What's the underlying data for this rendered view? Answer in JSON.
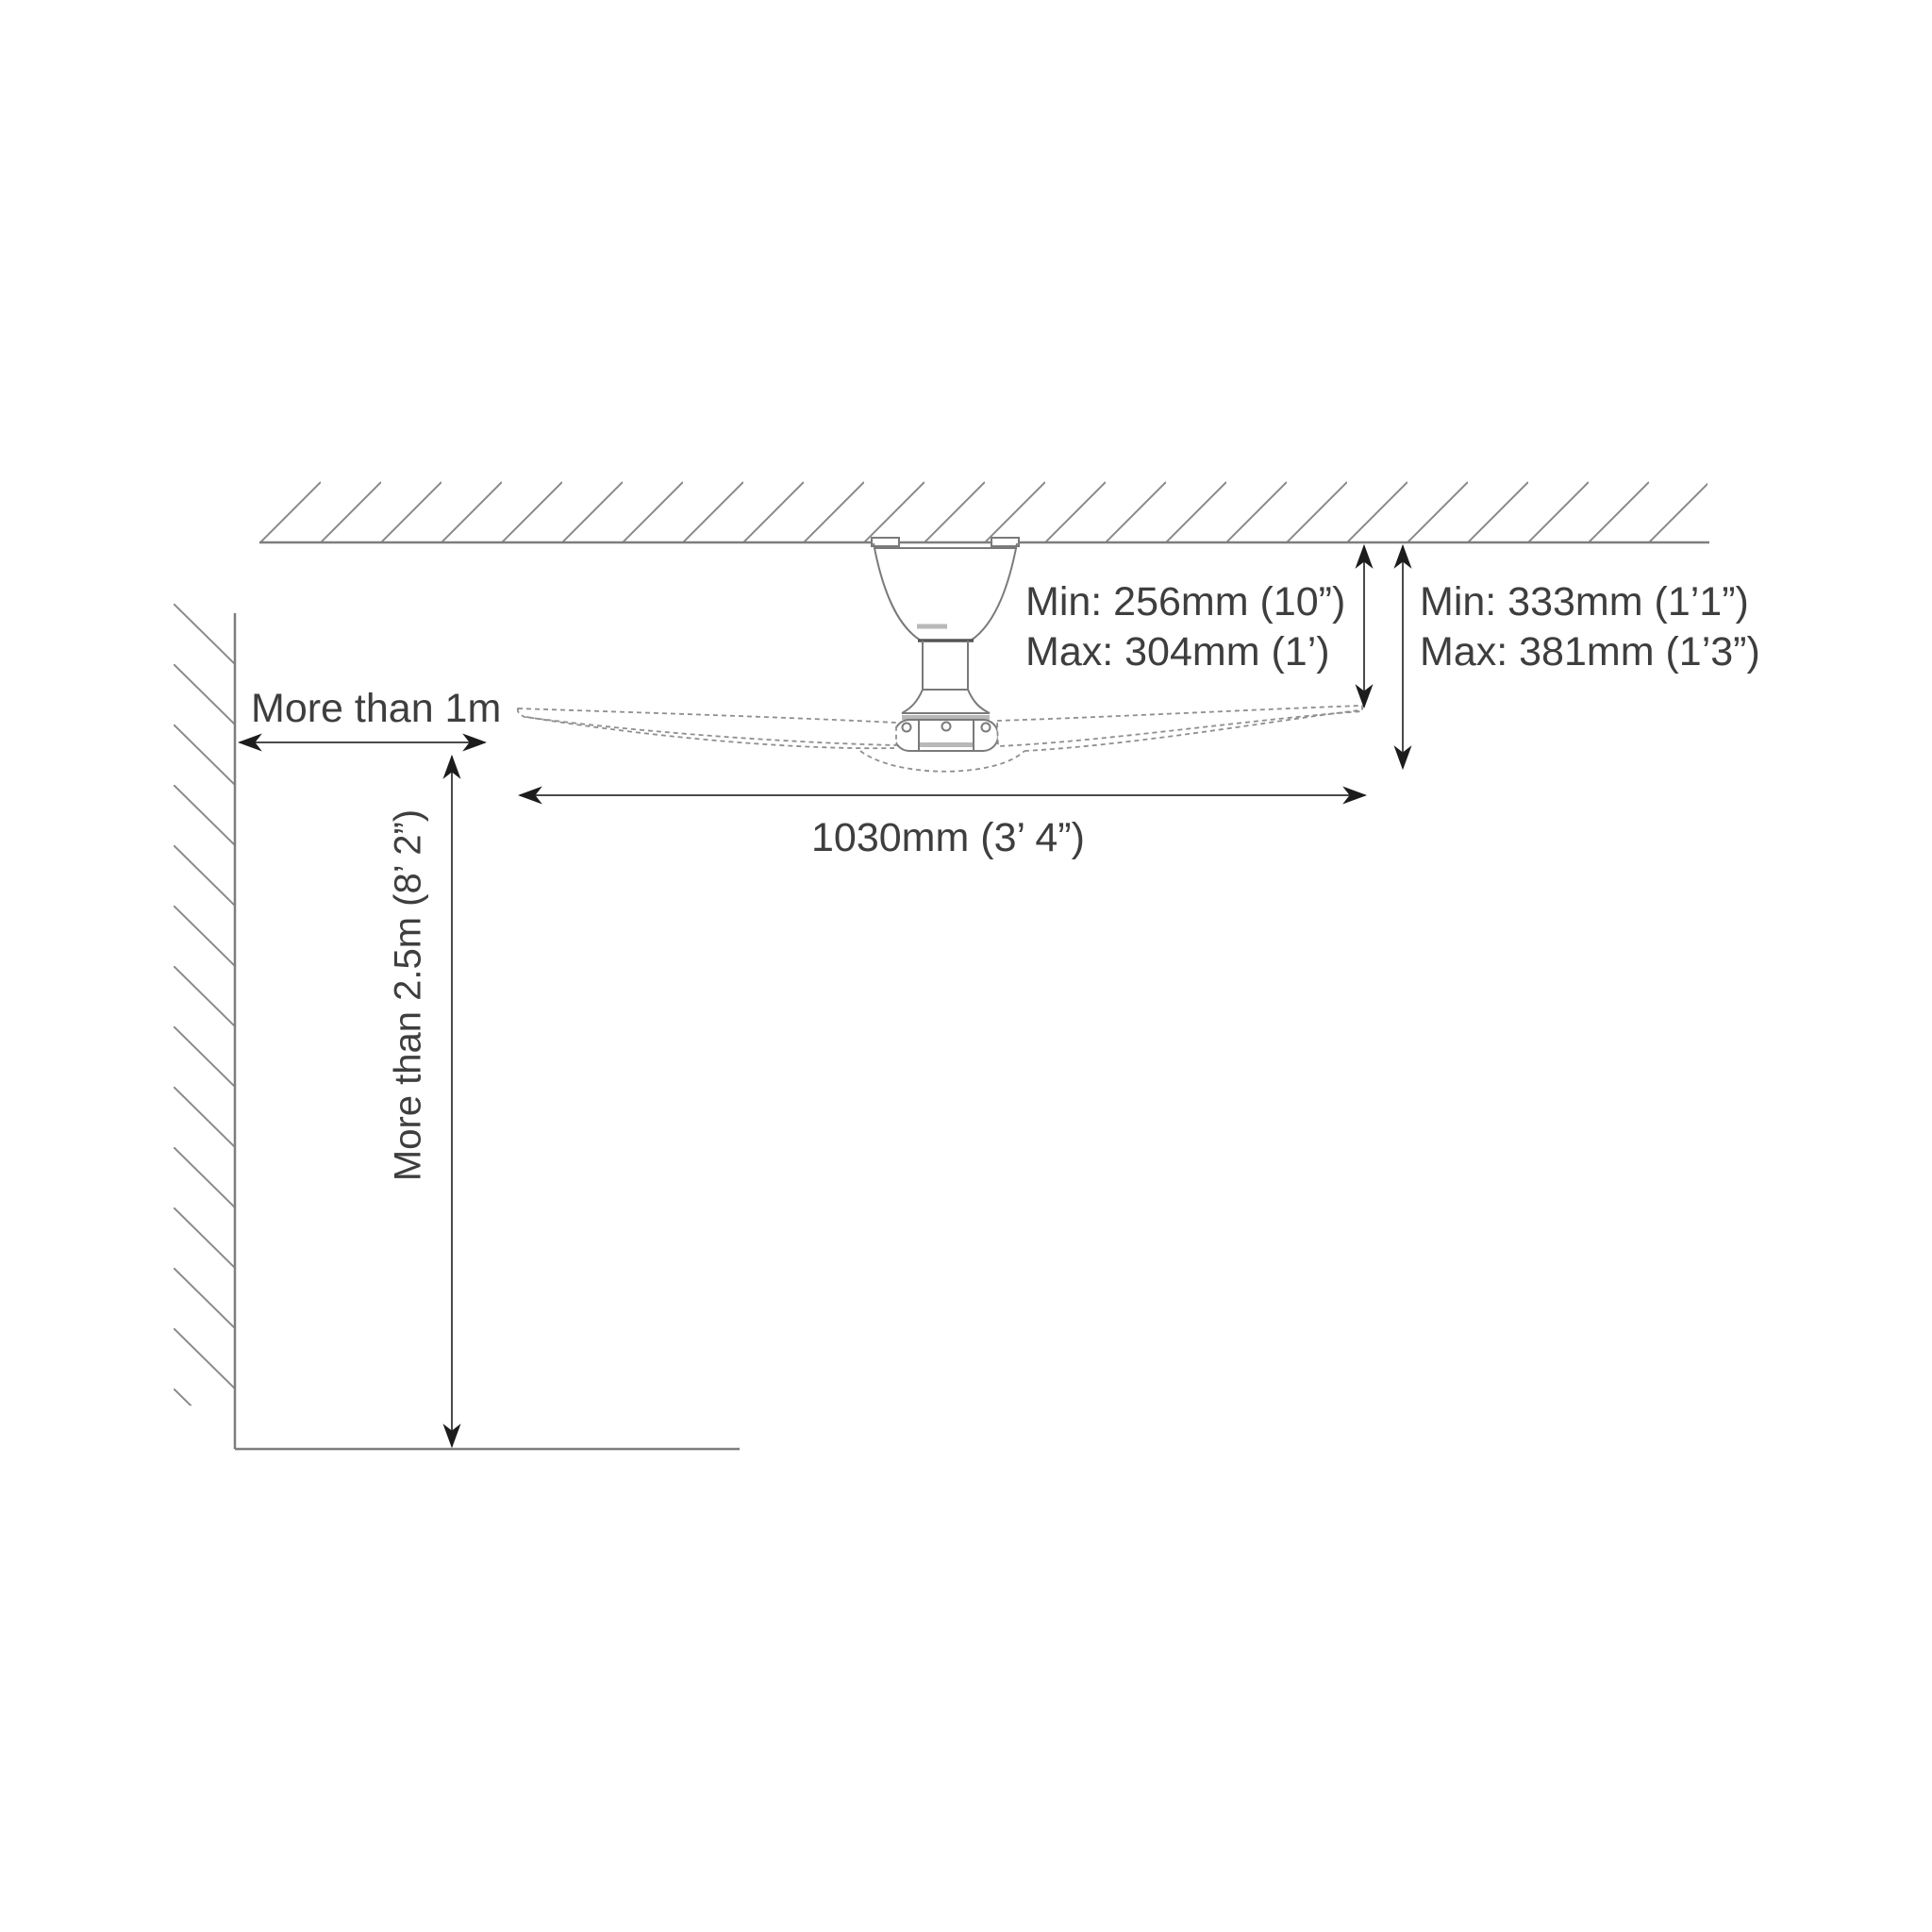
{
  "title": "Ceiling fan installation clearance diagram",
  "labels": {
    "wall_clearance": "More than 1m",
    "floor_clearance": "More than 2.5m (8’ 2”)",
    "fan_width": "1030mm  (3’ 4”)",
    "blade_to_ceiling": {
      "min": "Min: 256mm (10”)",
      "max": "Max: 304mm (1’)"
    },
    "body_to_ceiling": {
      "min": "Min: 333mm (1’1”)",
      "max": "Max: 381mm (1’3”)"
    }
  },
  "colors": {
    "background": "#ffffff",
    "text": "#3e3e3e",
    "structure_line": "#7d7d7d",
    "fan_line": "#7a7a7a",
    "blade_dash_line": "#8f8f8f",
    "dimension_line": "#4a4a4a",
    "arrowhead": "#1c1c1c",
    "metal_band": "#b8b8b8"
  }
}
